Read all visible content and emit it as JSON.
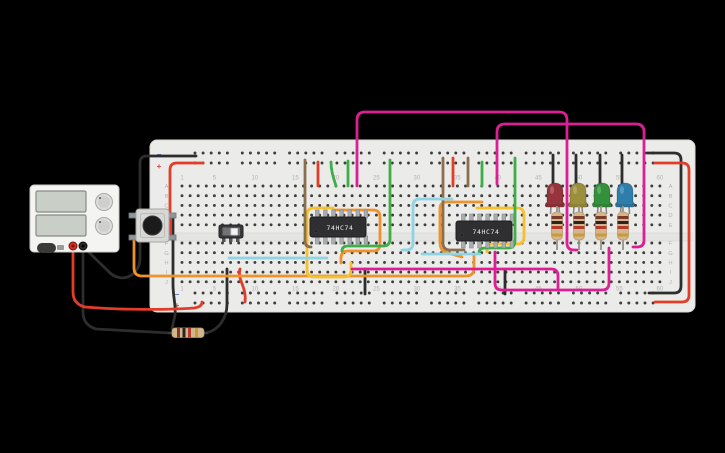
{
  "app": {
    "background": "#000000",
    "width": 725,
    "height": 453
  },
  "breadboard": {
    "column_numbers": [
      "1",
      "5",
      "10",
      "15",
      "20",
      "25",
      "30",
      "35",
      "40",
      "45",
      "50",
      "55",
      "60"
    ],
    "row_letters": [
      "A",
      "B",
      "C",
      "D",
      "E",
      "F",
      "G",
      "H",
      "I",
      "J"
    ],
    "rail_markers": [
      {
        "glyph": "−",
        "x": 159,
        "y": 157,
        "color": "#4a7dc4"
      },
      {
        "glyph": "+",
        "x": 159,
        "y": 169,
        "color": "#c94a40"
      },
      {
        "glyph": "−",
        "x": 177,
        "y": 297,
        "color": "#4a7dc4"
      },
      {
        "glyph": "+",
        "x": 177,
        "y": 308,
        "color": "#c94a40"
      }
    ],
    "label_color": "#b3b3b1",
    "board_color": "#ebebe9",
    "hole_color": "#3d3d3b"
  },
  "components": [
    {
      "type": "power-supply",
      "name": "power-supply",
      "x": 30,
      "y": 185
    },
    {
      "type": "push-button",
      "name": "push-button",
      "x": 136,
      "y": 209
    },
    {
      "type": "slide-switch",
      "name": "slide-switch",
      "x": 219,
      "y": 225
    },
    {
      "type": "ic",
      "name": "ic-flipflop-1",
      "x": 310,
      "y": 217,
      "label": "74HC74"
    },
    {
      "type": "ic",
      "name": "ic-flipflop-2",
      "x": 456,
      "y": 221,
      "label": "74HC74"
    },
    {
      "type": "led",
      "name": "led-red",
      "x": 555,
      "y": 183,
      "color": "#97343b"
    },
    {
      "type": "led",
      "name": "led-yellow",
      "x": 578,
      "y": 183,
      "color": "#9c8f3c"
    },
    {
      "type": "led",
      "name": "led-green",
      "x": 602,
      "y": 183,
      "color": "#33913c"
    },
    {
      "type": "led",
      "name": "led-blue",
      "x": 625,
      "y": 183,
      "color": "#2e7eac"
    },
    {
      "type": "resistor-v",
      "name": "resistor-led-1",
      "x": 557,
      "y": 206
    },
    {
      "type": "resistor-v",
      "name": "resistor-led-2",
      "x": 579,
      "y": 206
    },
    {
      "type": "resistor-v",
      "name": "resistor-led-3",
      "x": 601,
      "y": 206
    },
    {
      "type": "resistor-v",
      "name": "resistor-led-4",
      "x": 623,
      "y": 206
    },
    {
      "type": "resistor-h",
      "name": "resistor-pulldown",
      "x": 172,
      "y": 328
    }
  ],
  "wires": [
    {
      "name": "psu-black-lead",
      "color": "#2d2d2d",
      "d": "M 83 247 L 83 312 Q 83 325 96 329 L 170 333"
    },
    {
      "name": "resistor-row-jumper-black",
      "color": "#2d2d2d",
      "d": "M 206 333 C 219 330 227 318 227 304 L 227 269"
    },
    {
      "name": "button-ground-black",
      "color": "#2d2d2d",
      "d": "M 173 215 L 173 284 C 173 297 176 305 175 315 L 172 329"
    },
    {
      "name": "rail-feed-black",
      "color": "#2d2d2d",
      "d": "M 196 156 L 147 156 Q 140 156 140 163 L 140 258 C 140 276 121 285 108 271 C 99 262 90 254 85 248"
    },
    {
      "name": "led-cathode-1",
      "color": "#2d2d2d",
      "d": "M 553 155 L 553 190"
    },
    {
      "name": "led-cathode-2",
      "color": "#2d2d2d",
      "d": "M 576 155 L 576 190"
    },
    {
      "name": "led-cathode-3",
      "color": "#2d2d2d",
      "d": "M 600 155 L 600 190"
    },
    {
      "name": "led-cathode-4",
      "color": "#2d2d2d",
      "d": "M 622 155 L 622 190"
    },
    {
      "name": "right-rail-link-black",
      "color": "#2d2d2d",
      "d": "M 647 153 L 674 153 Q 681 153 681 160 L 681 286 Q 681 293 674 293 L 649 293"
    },
    {
      "name": "bottom-jumper-black-1",
      "color": "#2d2d2d",
      "d": "M 365 269 L 365 294"
    },
    {
      "name": "bottom-jumper-black-2",
      "color": "#2d2d2d",
      "d": "M 505 270 L 505 294"
    },
    {
      "name": "psu-red-lead",
      "color": "#e23d28",
      "d": "M 73 247 L 73 292 Q 73 304 85 307 C 120 310 168 310 194 308 Q 202 307 202 302"
    },
    {
      "name": "button-power-red",
      "color": "#e23d28",
      "d": "M 203 163 L 177 163 Q 170 163 170 170 L 170 237"
    },
    {
      "name": "red-jumper-a",
      "color": "#e23d28",
      "d": "M 318 162 L 318 186"
    },
    {
      "name": "red-jumper-b",
      "color": "#e23d28",
      "d": "M 453 158 L 453 186"
    },
    {
      "name": "right-rail-link-red",
      "color": "#e23d28",
      "d": "M 655 163 L 682 163 Q 689 163 689 170 L 689 295 Q 689 302 682 302 L 655 302"
    },
    {
      "name": "bottom-red-jumper",
      "color": "#e23d28",
      "d": "M 240 269 C 237 280 247 287 245 302"
    },
    {
      "name": "orange-button-run",
      "color": "#f0922b",
      "d": "M 134 240 L 134 268 Q 134 276 142 276 L 466 276 Q 474 276 474 268 L 474 256"
    },
    {
      "name": "orange-ic1-loop",
      "color": "#f0922b",
      "d": "M 333 210 L 373 210 Q 380 210 380 217 L 380 244 Q 380 251 373 251 L 348 251 Q 341 251 341 258 L 341 263"
    },
    {
      "name": "orange-ic2-loop",
      "color": "#f0922b",
      "d": "M 482 202 L 447 202 Q 440 202 440 209 L 440 243 Q 440 251 448 253 L 462 257"
    },
    {
      "name": "yellow-ic1-loop",
      "color": "#f5c02c",
      "d": "M 333 208 L 314 208 Q 307 208 307 215 L 307 270 Q 307 277 314 277 L 344 277 Q 351 277 351 270 L 351 263"
    },
    {
      "name": "yellow-ic2-loop",
      "color": "#f5c02c",
      "d": "M 477 208 L 517 208 Q 524 208 524 215 L 524 237 Q 524 244 517 244 L 493 244 Q 487 244 487 250 L 487 252"
    },
    {
      "name": "green-jumper-1",
      "color": "#3fae46",
      "d": "M 331 162 C 331 172 334 179 336 186"
    },
    {
      "name": "green-jumper-2",
      "color": "#3fae46",
      "d": "M 348 161 L 348 186"
    },
    {
      "name": "green-ic1-link",
      "color": "#3fae46",
      "d": "M 390 160 L 390 239 Q 390 246 383 246 L 348 246 Q 342 246 342 251"
    },
    {
      "name": "green-jumper-3",
      "color": "#3fae46",
      "d": "M 482 162 L 482 186"
    },
    {
      "name": "green-ic2-link",
      "color": "#3fae46",
      "d": "M 515 158 L 515 241 Q 515 248 508 248 L 485 248 Q 479 248 479 253"
    },
    {
      "name": "brown-ic1-link",
      "color": "#8a6f4d",
      "d": "M 305 160 L 305 241 Q 305 247 311 247"
    },
    {
      "name": "brown-ic2-link",
      "color": "#8a6f4d",
      "d": "M 443 158 L 443 243 Q 443 250 450 250 L 464 250"
    },
    {
      "name": "brown-jumper",
      "color": "#8a6f4d",
      "d": "M 468 158 L 468 186"
    },
    {
      "name": "cyan-row-link-1",
      "color": "#8ed4e4",
      "d": "M 229 258 L 327 258"
    },
    {
      "name": "cyan-ic2-link",
      "color": "#8ed4e4",
      "d": "M 452 199 L 420 199 Q 413 199 413 206 L 413 243 Q 413 250 406 250 L 402 250"
    },
    {
      "name": "cyan-row-link-2",
      "color": "#8ed4e4",
      "d": "M 422 254 L 480 254"
    },
    {
      "name": "magenta-arc-1",
      "color": "#dd1f96",
      "d": "M 357 186 L 357 120 Q 357 112 365 112 L 559 112 Q 567 112 567 120 L 567 243 Q 567 250 574 250 L 577 250"
    },
    {
      "name": "magenta-arc-2",
      "color": "#dd1f96",
      "d": "M 497 184 L 497 132 Q 497 124 505 124 L 636 124 Q 644 124 644 132 L 644 240 Q 644 247 637 247 L 633 247"
    },
    {
      "name": "magenta-run-1",
      "color": "#dd1f96",
      "d": "M 352 269 L 551 269 Q 558 269 558 276 L 558 288"
    },
    {
      "name": "magenta-run-2",
      "color": "#dd1f96",
      "d": "M 495 252 L 495 283 Q 495 290 502 290 L 602 290 Q 609 290 609 283 L 609 248"
    }
  ]
}
